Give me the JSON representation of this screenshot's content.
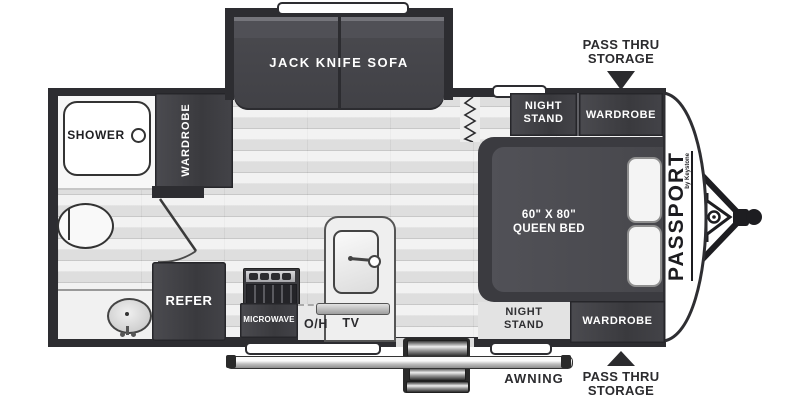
{
  "diagram": {
    "type": "travel-trailer floor plan",
    "brand": "PASSPORT",
    "brand_sub": "by Keystone",
    "labels": {
      "sofa": "JACK KNIFE SOFA",
      "shower": "SHOWER",
      "wardrobe": "WARDROBE",
      "night_stand_l1": "NIGHT",
      "night_stand_l2": "STAND",
      "bed_size": "60\" X 80\"",
      "bed_type": "QUEEN BED",
      "refer": "REFER",
      "microwave": "MICROWAVE",
      "overhead": "O/H",
      "tv": "TV",
      "awning": "AWNING",
      "pass_thru_l1": "PASS THRU",
      "pass_thru_l2": "STORAGE"
    },
    "colors": {
      "wall": "#2d2d31",
      "furniture": "#404045",
      "floor": "#e7e7e7",
      "text_dark": "#2b2b2e",
      "text_light": "#ffffff"
    }
  }
}
